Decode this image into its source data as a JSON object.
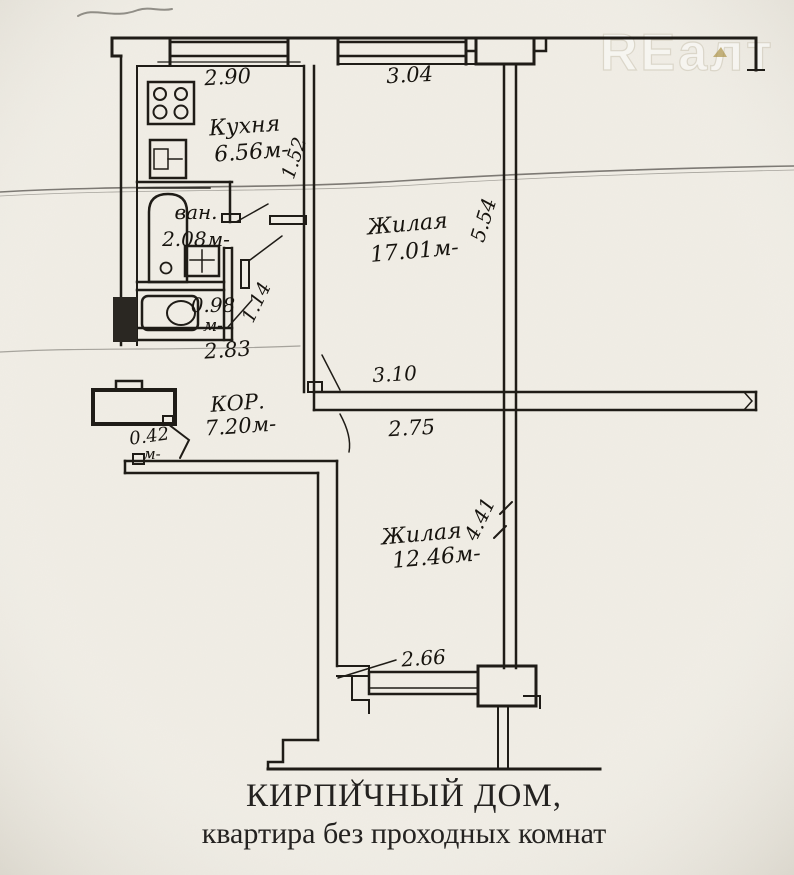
{
  "watermark": "REалт",
  "rooms": {
    "kitchen": {
      "name": "Кухня",
      "area": "6.56м-"
    },
    "living_top": {
      "name": "Жилая",
      "area": "17.01м-"
    },
    "living_bottom": {
      "name": "Жилая",
      "area": "12.46м-"
    },
    "bathroom": {
      "name": "ван.",
      "area": "2.08м-"
    },
    "wc": {
      "area": "0.98",
      "unit": "м-"
    },
    "corridor": {
      "name": "КОР.",
      "area": "7.20м-"
    },
    "entry": {
      "width": "0.42",
      "unit": "м-"
    }
  },
  "dimensions": {
    "kitchen_window": "2.90",
    "living_top_window": "3.04",
    "living_top_depth": "5.54",
    "kitchen_depth": "1.52",
    "wc_diagonal": "1.14",
    "corridor_span": "2.83",
    "mid_wall_upper": "3.10",
    "mid_wall_lower": "2.75",
    "living_bottom_depth": "4.41",
    "bottom_window": "2.66"
  },
  "caption": {
    "line1": "КИРПИЧНЫЙ ДОМ,",
    "line2": "квартира без проходных комнат"
  },
  "colors": {
    "paper": "#f1eee6",
    "ink": "#1f1c17",
    "crease": "#b3ac9c",
    "watermark_fill": "#f7f6f2",
    "watermark_stroke": "#d9d4c7"
  }
}
